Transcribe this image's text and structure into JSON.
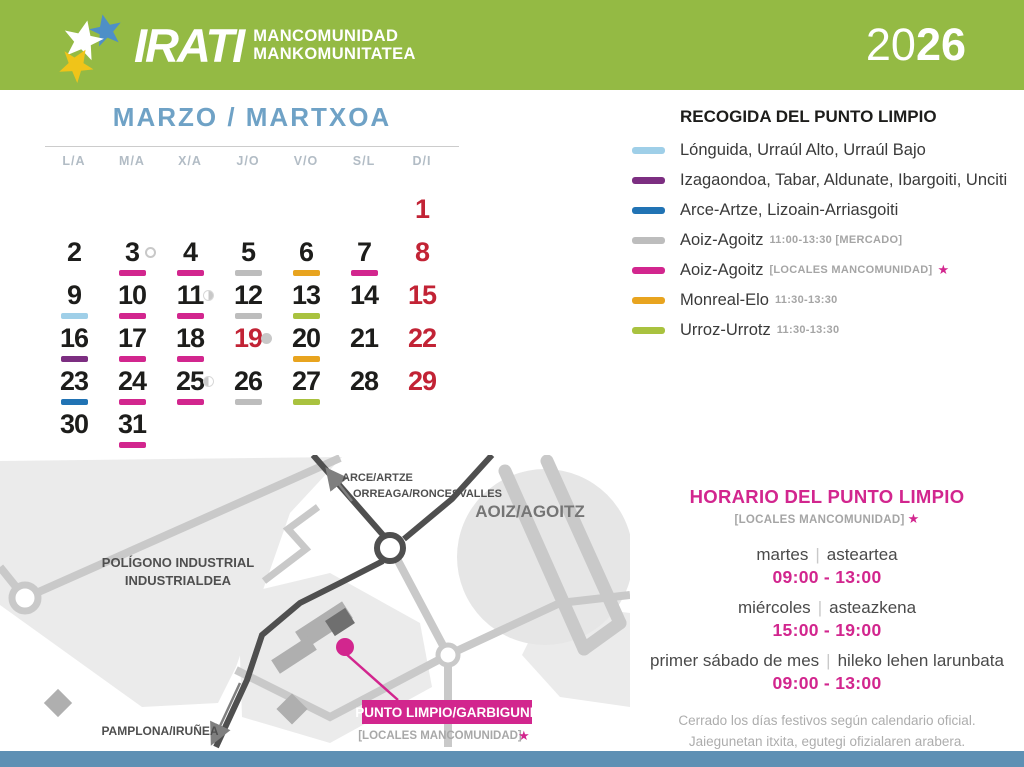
{
  "colors": {
    "pink": "#D2268E",
    "gray": "#BDBDBD",
    "orange": "#E8A41F",
    "lightblue": "#9FCFE8",
    "green": "#A9C23F",
    "purple": "#7C2E81",
    "blue": "#2173B4",
    "sunday_red": "#C22335",
    "header_green": "#94BA44",
    "title_blue": "#6FA2C6",
    "footer_blue": "#5E90B4",
    "moon_gray": "#C8C8C8"
  },
  "header": {
    "brand": "IRATI",
    "org_line1": "MANCOMUNIDAD",
    "org_line2": "MANKOMUNITATEA",
    "year_prefix": "20",
    "year_suffix": "26"
  },
  "calendar": {
    "title": "MARZO / MARTXOA",
    "weekday_headers": [
      "L/A",
      "M/A",
      "X/A",
      "J/O",
      "V/O",
      "S/L",
      "D/I"
    ],
    "days": [
      {
        "n": "1",
        "red": true,
        "col": 7
      },
      {
        "n": "2"
      },
      {
        "n": "3",
        "u": "pink",
        "moon": "full"
      },
      {
        "n": "4",
        "u": "pink"
      },
      {
        "n": "5",
        "u": "gray"
      },
      {
        "n": "6",
        "u": "orange"
      },
      {
        "n": "7",
        "u": "pink"
      },
      {
        "n": "8",
        "red": true
      },
      {
        "n": "9",
        "u": "lightblue"
      },
      {
        "n": "10",
        "u": "pink"
      },
      {
        "n": "11",
        "u": "pink",
        "moon": "last-quarter"
      },
      {
        "n": "12",
        "u": "gray"
      },
      {
        "n": "13",
        "u": "green"
      },
      {
        "n": "14"
      },
      {
        "n": "15",
        "red": true
      },
      {
        "n": "16",
        "u": "purple"
      },
      {
        "n": "17",
        "u": "pink"
      },
      {
        "n": "18",
        "u": "pink"
      },
      {
        "n": "19",
        "red": true,
        "moon": "new"
      },
      {
        "n": "20",
        "u": "orange"
      },
      {
        "n": "21"
      },
      {
        "n": "22",
        "red": true
      },
      {
        "n": "23",
        "u": "blue"
      },
      {
        "n": "24",
        "u": "pink"
      },
      {
        "n": "25",
        "u": "pink",
        "moon": "first-quarter"
      },
      {
        "n": "26",
        "u": "gray"
      },
      {
        "n": "27",
        "u": "green"
      },
      {
        "n": "28"
      },
      {
        "n": "29",
        "red": true
      },
      {
        "n": "30"
      },
      {
        "n": "31",
        "u": "pink"
      }
    ]
  },
  "legend": {
    "title": "RECOGIDA DEL PUNTO LIMPIO",
    "star": "★",
    "items": [
      {
        "color": "lightblue",
        "label": "Lónguida, Urraúl Alto, Urraúl Bajo"
      },
      {
        "color": "purple",
        "label": "Izagaondoa, Tabar, Aldunate, Ibargoiti, Unciti"
      },
      {
        "color": "blue",
        "label": "Arce-Artze, Lizoain-Arriasgoiti"
      },
      {
        "color": "gray",
        "label": "Aoiz-Agoitz",
        "time": "11:00-13:30 [MERCADO]"
      },
      {
        "color": "pink",
        "label": "Aoiz-Agoitz",
        "time": "[LOCALES MANCOMUNIDAD]",
        "star": true
      },
      {
        "color": "orange",
        "label": "Monreal-Elo",
        "time": "11:30-13:30"
      },
      {
        "color": "green",
        "label": "Urroz-Urrotz",
        "time": "11:30-13:30"
      }
    ]
  },
  "map": {
    "area_label_line1": "POLÍGONO INDUSTRIAL",
    "area_label_line2": "INDUSTRIALDEA",
    "town_label": "AOIZ/AGOITZ",
    "direction_north_line1": "ARCE/ARTZE",
    "direction_north_line2": "ORREAGA/RONCESVALLES",
    "direction_south": "PAMPLONA/IRUÑEA",
    "marker_label": "PUNTO LIMPIO/GARBIGUNE",
    "marker_sub": "[LOCALES MANCOMUNIDAD]",
    "star": "★"
  },
  "schedule": {
    "title": "HORARIO DEL PUNTO LIMPIO",
    "subtitle": "[LOCALES MANCOMUNIDAD]",
    "star": "★",
    "separator": "|",
    "rows": [
      {
        "es": "martes",
        "eu": "asteartea",
        "time": "09:00 - 13:00"
      },
      {
        "es": "miércoles",
        "eu": "asteazkena",
        "time": "15:00 - 19:00"
      },
      {
        "es": "primer sábado de mes",
        "eu": "hileko lehen larunbata",
        "time": "09:00 - 13:00"
      }
    ],
    "note_line1": "Cerrado los días festivos según calendario oficial.",
    "note_line2": "Jaiegunetan itxita, egutegi ofizialaren arabera."
  }
}
